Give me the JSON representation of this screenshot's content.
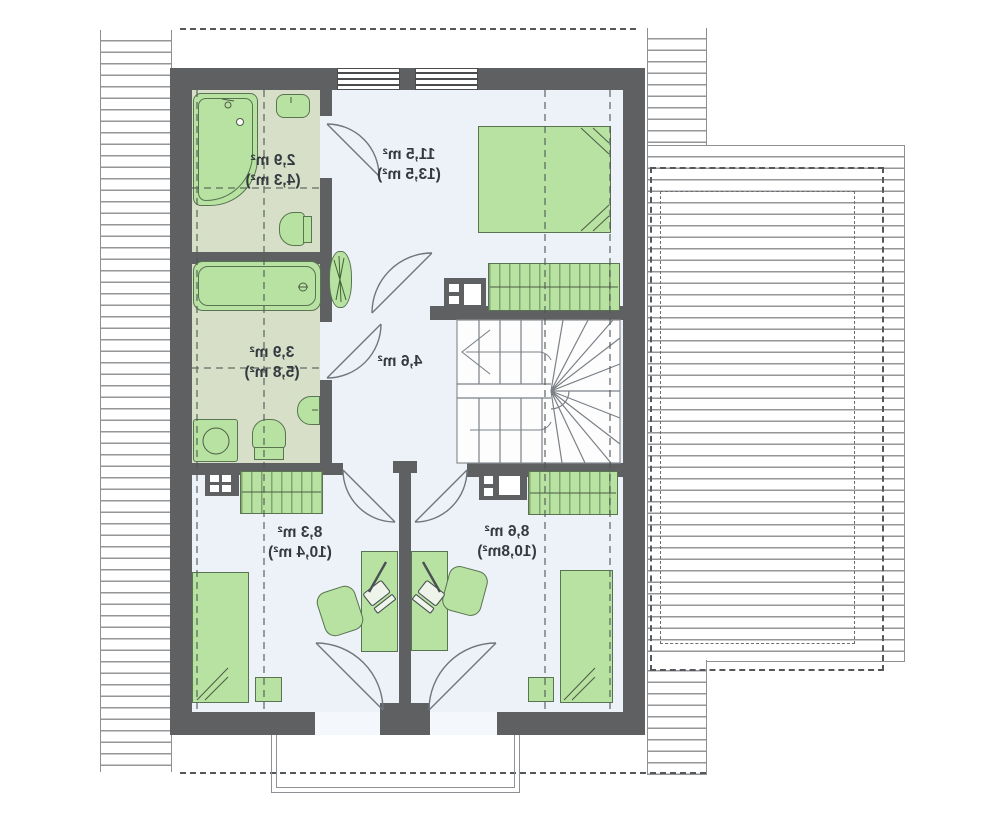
{
  "floor_plan": {
    "kind": "attic-storey-floor-plan",
    "rooms": [
      {
        "name": "ensuite-bathroom",
        "area": "2,9 m²",
        "area_total": "(4,3 m²)"
      },
      {
        "name": "bedroom",
        "area": "11,5 m²",
        "area_total": "(13,5 m²)"
      },
      {
        "name": "bathroom",
        "area": "3,9 m²",
        "area_total": "(5,8 m²)"
      },
      {
        "name": "hall",
        "area": "4,6 m²",
        "area_total": ""
      },
      {
        "name": "room-bottom-left",
        "area": "8,3 m²",
        "area_total": "(10,4 m²)"
      },
      {
        "name": "room-bottom-right",
        "area": "8,6 m²",
        "area_total": "(10,8m²)"
      }
    ],
    "furniture_symbols": [
      "bathtub",
      "sink",
      "toilet",
      "washing-machine",
      "bed",
      "wardrobe",
      "dresser",
      "nightstand",
      "desk",
      "office-chair",
      "laptop",
      "potted-plant",
      "staircase",
      "door-arc",
      "window",
      "balcony",
      "roof-hatch"
    ],
    "colors": {
      "wall": "#5e6062",
      "furniture_green": "#b8e2a2",
      "furniture_border": "#587450",
      "bathroom_floor": "#d8dfc8",
      "room_floor": "#edf1f8",
      "hatch_line": "#949698",
      "dashed_line": "#55585a",
      "label_text": "#333a40"
    },
    "text_mirrored": true
  }
}
